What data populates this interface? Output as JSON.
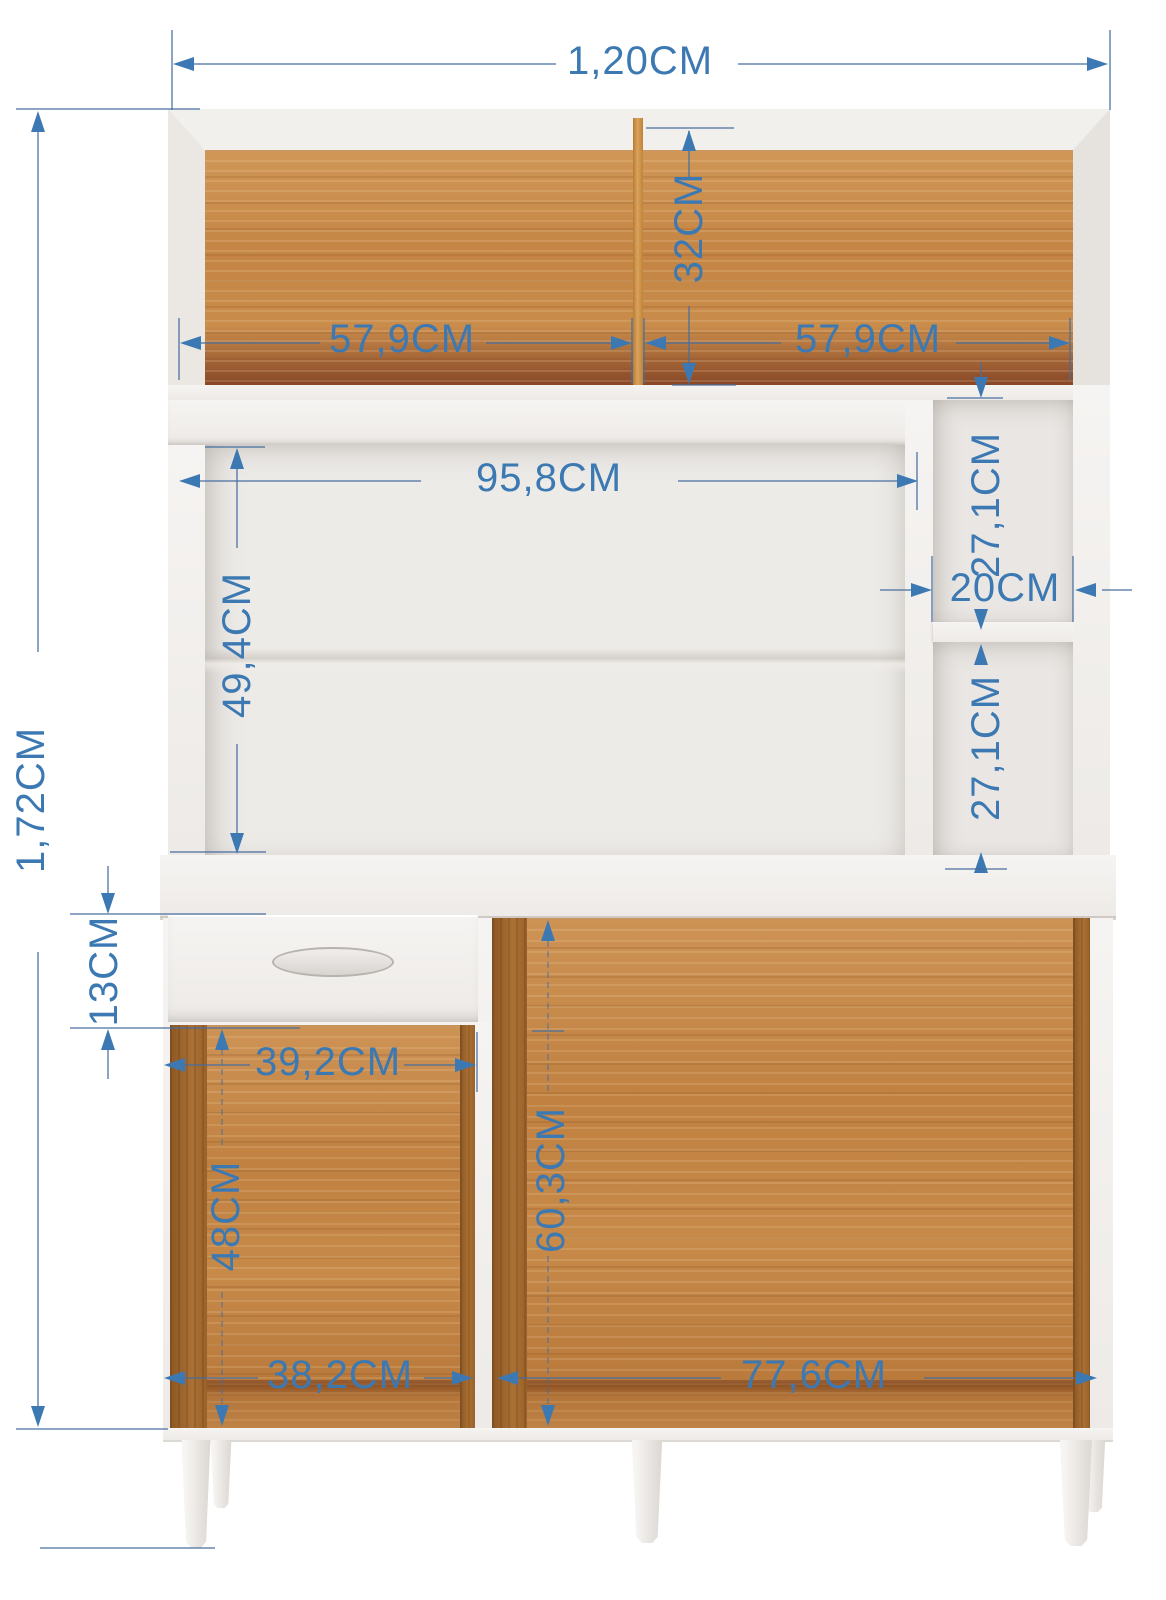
{
  "diagram": {
    "kind": "furniture-dimension-diagram",
    "unit": "CM",
    "colors": {
      "dimension_blue": "#3c79b3",
      "wood_back": "#c78a49",
      "wood_side_dark": "#9a6229",
      "cabinet_white": "#f2f0ed",
      "inner_back_gray": "#edebe8",
      "background": "#ffffff"
    }
  },
  "dims": {
    "overall_width": "1,20CM",
    "overall_height": "1,72CM",
    "hutch_back_height": "32CM",
    "hutch_left_width": "57,9CM",
    "hutch_right_width": "57,9CM",
    "middle_opening_width": "95,8CM",
    "middle_opening_height": "49,4CM",
    "cubby_top_height": "27,1CM",
    "cubby_width": "20CM",
    "cubby_bottom_height": "27,1CM",
    "drawer_height": "13CM",
    "left_opening_top_width": "39,2CM",
    "left_opening_height": "48CM",
    "right_opening_height": "60,3CM",
    "left_opening_bottom_width": "38,2CM",
    "right_opening_width": "77,6CM"
  }
}
